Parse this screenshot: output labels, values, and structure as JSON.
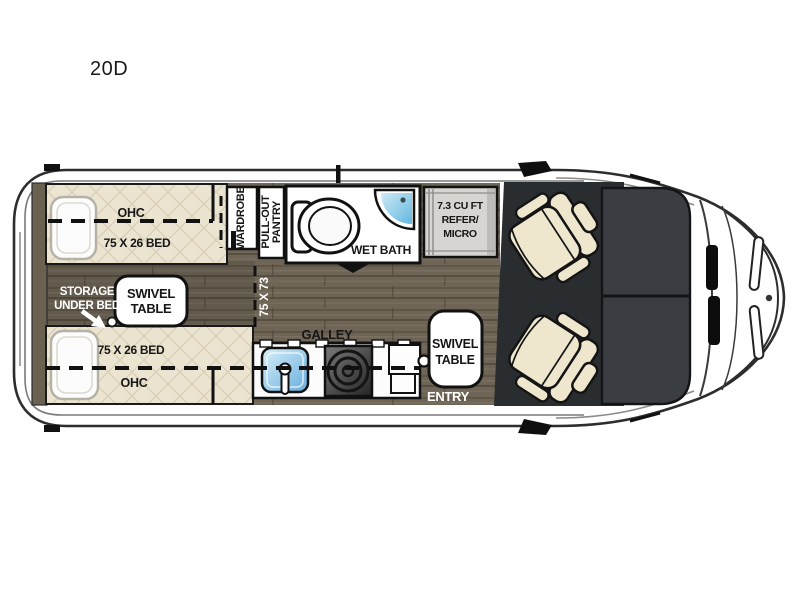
{
  "title": "20D",
  "plan": {
    "bed_top": {
      "ohc": "OHC",
      "size": "75 X 26 BED"
    },
    "bed_bottom": {
      "size": "75 X 26 BED",
      "ohc": "OHC"
    },
    "storage": {
      "line1": "STORAGE",
      "line2": "UNDER BED"
    },
    "swivel_rear": {
      "line1": "SWIVEL",
      "line2": "TABLE"
    },
    "wardrobe": {
      "label": "WARDROBE"
    },
    "pantry": {
      "line1": "PULL-OUT",
      "line2": "PANTRY"
    },
    "wet_bath": {
      "label": "WET BATH"
    },
    "dimension": {
      "label": "75 X 73"
    },
    "refrigerator": {
      "line1": "7.3 CU FT",
      "line2": "REFER/",
      "line3": "MICRO"
    },
    "galley": {
      "label": "GALLEY"
    },
    "swivel_front": {
      "line1": "SWIVEL",
      "line2": "TABLE"
    },
    "entry": {
      "label": "ENTRY"
    },
    "colors": {
      "wood_floor": "#6e6556",
      "bed_quilt": "#ebe4d1",
      "quilt_line": "#d8cfb6",
      "cab_mat": "#2a2d30",
      "windshield": "#3a3e42",
      "seat_cream": "#eee6cd",
      "shower_blue": "#62b8e0",
      "sink_blue": "#64aedd",
      "refrigerator_gray": "#d6d5d1",
      "outline": "#2d2d2d"
    }
  }
}
